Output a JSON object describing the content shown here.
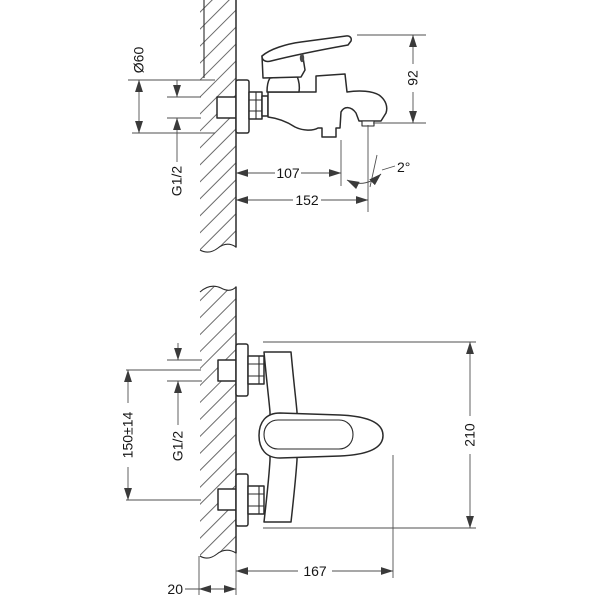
{
  "drawing": {
    "type": "technical-installation-diagram",
    "subject": "wall-mounted bath mixer faucet, two projection views with dimensions (mm)",
    "colors": {
      "background": "#ffffff",
      "outline": "#2b2b2b",
      "dimension": "#4f4f4f",
      "hatch": "#6b6b6b"
    },
    "side_view": {
      "name": "side view (upper drawing)",
      "dims": {
        "diameter": "Ø60",
        "thread": "G1/2",
        "reach": "107",
        "total_reach": "152",
        "angle": "2°",
        "height": "92"
      }
    },
    "top_view": {
      "name": "top view (lower drawing)",
      "dims": {
        "centers": "150±14",
        "thread": "G1/2",
        "length": "167",
        "wall_thickness": "20",
        "width": "210"
      }
    }
  }
}
